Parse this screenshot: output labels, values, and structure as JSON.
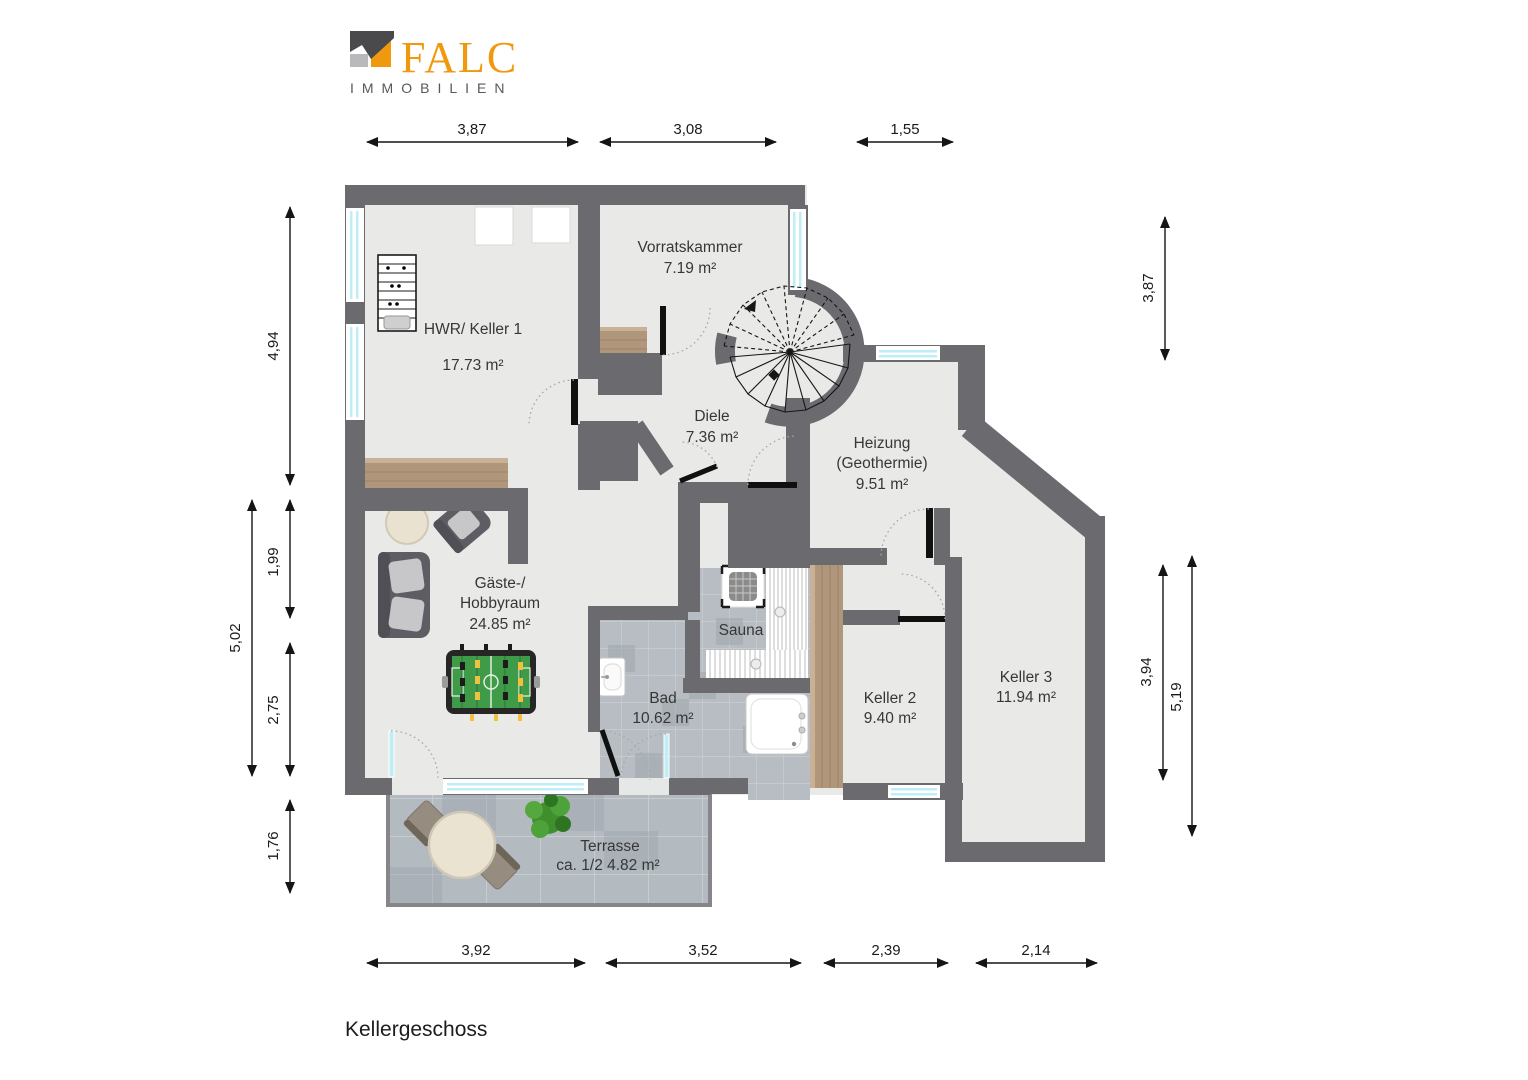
{
  "logo": {
    "brand": "FALC",
    "subtitle": "IMMOBILIEN"
  },
  "title": "Kellergeschoss",
  "rooms": {
    "vorratskammer": {
      "name": "Vorratskammer",
      "area": "7.19 m²"
    },
    "hwr": {
      "name": "HWR/ Keller 1",
      "area": "17.73 m²"
    },
    "diele": {
      "name": "Diele",
      "area": "7.36 m²"
    },
    "heizung": {
      "name": "Heizung",
      "name2": "(Geothermie)",
      "area": "9.51 m²"
    },
    "hobbyraum": {
      "name": "Gäste-/",
      "name2": "Hobbyraum",
      "area": "24.85 m²"
    },
    "sauna": {
      "name": "Sauna"
    },
    "bad": {
      "name": "Bad",
      "area": "10.62 m²"
    },
    "keller2": {
      "name": "Keller 2",
      "area": "9.40 m²"
    },
    "keller3": {
      "name": "Keller 3",
      "area": "11.94 m²"
    },
    "terrasse": {
      "name": "Terrasse",
      "area": "ca. 1/2 4.82 m²"
    }
  },
  "dimensions": {
    "top": [
      "3,87",
      "3,08",
      "1,55"
    ],
    "bottom": [
      "3,92",
      "3,52",
      "2,39",
      "2,14"
    ],
    "left": [
      "4,94",
      "1,99",
      "2,75",
      "1,76"
    ],
    "left_outer": "5,02",
    "right_top": "3,87",
    "right": [
      "3,94",
      "5,19"
    ]
  },
  "colors": {
    "wall": "#6a6a6f",
    "floor": "#e9e9e7",
    "tile": "#b7bdc2",
    "wood": "#b0967a",
    "glass": "#bfeef7",
    "brand_orange": "#f0990f",
    "foosball_green": "#3f9b47"
  }
}
